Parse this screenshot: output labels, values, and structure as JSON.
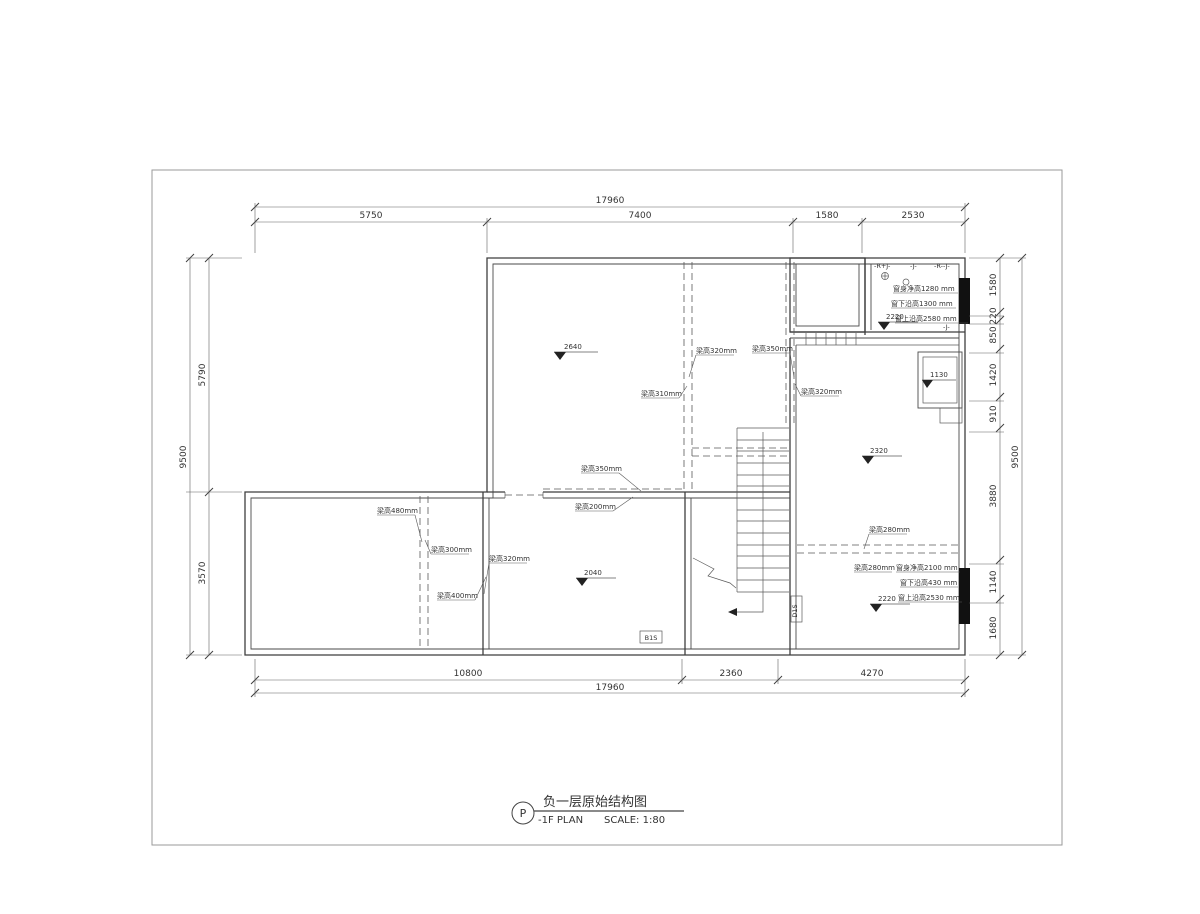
{
  "title_block": {
    "tag": "P",
    "title_cn": "负一层原始结构图",
    "title_en": "-1F PLAN",
    "scale_label": "SCALE: 1:80"
  },
  "dims": {
    "top_total": "17960",
    "top": [
      "5750",
      "7400",
      "1580",
      "2530"
    ],
    "bottom": [
      "10800",
      "2360",
      "4270"
    ],
    "bottom_total": "17960",
    "left_total": "9500",
    "left": [
      "5790",
      "3570"
    ],
    "right_total": "9500",
    "right": [
      "1580",
      "220",
      "850",
      "1420",
      "910",
      "3880",
      "1140",
      "1680"
    ]
  },
  "levels": {
    "upper_room": "2640",
    "top_right_room": "2220",
    "niche": "1130",
    "right_room": "2320",
    "middle_room": "2040",
    "bottom_right": "2220"
  },
  "beams": {
    "b1": "梁高320mm",
    "b2": "梁高350mm",
    "b3": "梁高310mm",
    "b4": "梁高320mm",
    "b5": "梁高350mm",
    "b6": "梁高200mm",
    "b7": "梁高480mm",
    "b8": "梁高300mm",
    "b9": "梁高320mm",
    "b10": "梁高400mm",
    "b11": "梁高280mm",
    "b12": "梁高280mm"
  },
  "windows": {
    "top": {
      "height": "窗身净高1280 mm",
      "sill": "窗下沿高1300 mm",
      "head": "窗上沿高2580 mm"
    },
    "bottom": {
      "height": "窗身净高2100 mm",
      "sill": "窗下沿高430 mm",
      "head": "窗上沿高2530 mm"
    }
  },
  "tags": {
    "t1": "-R+J-",
    "t2": "-J-",
    "t3": "-R--J-",
    "t4": "-J-",
    "door1": "B1S",
    "door2": "D1S"
  }
}
